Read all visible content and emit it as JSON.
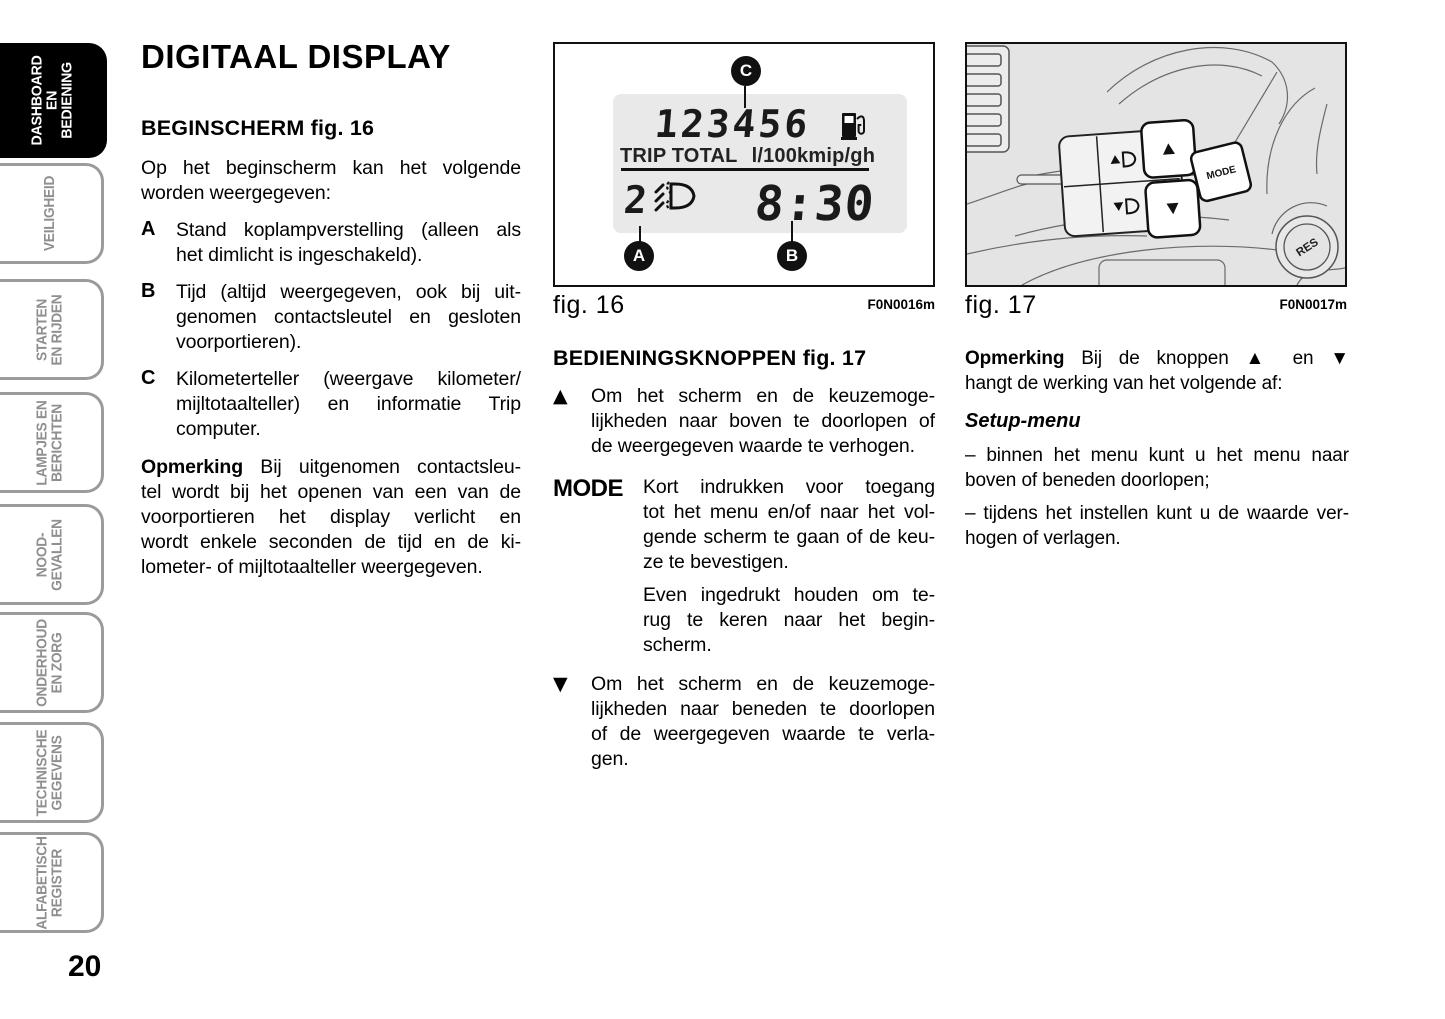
{
  "page": {
    "number": "20"
  },
  "sidebar": {
    "tabs": [
      {
        "id": "dashboard-en-bediening",
        "active": true,
        "lines": [
          "DASHBOARD",
          "EN BEDIENING"
        ]
      },
      {
        "id": "veiligheid",
        "active": false,
        "lines": [
          "VEILIGHEID"
        ]
      },
      {
        "id": "starten-en-rijden",
        "active": false,
        "lines": [
          "STARTEN",
          "EN RIJDEN"
        ]
      },
      {
        "id": "lampjes-en-berichten",
        "active": false,
        "lines": [
          "LAMPJES EN",
          "BERICHTEN"
        ]
      },
      {
        "id": "nood-gevallen",
        "active": false,
        "lines": [
          "NOOD-",
          "GEVALLEN"
        ]
      },
      {
        "id": "onderhoud-en-zorg",
        "active": false,
        "lines": [
          "ONDERHOUD",
          "EN ZORG"
        ]
      },
      {
        "id": "technische-gegevens",
        "active": false,
        "lines": [
          "TECHNISCHE",
          "GEGEVENS"
        ]
      },
      {
        "id": "alfabetisch-register",
        "active": false,
        "lines": [
          "ALFABETISCH",
          "REGISTER"
        ]
      }
    ]
  },
  "left_column": {
    "title": "DIGITAAL DISPLAY",
    "section_heading": "BEGINSCHERM fig. 16",
    "intro_lines": [
      "Op het beginscherm kan het volgende",
      "worden weergegeven:"
    ],
    "items": [
      {
        "key": "A",
        "lines": [
          "Stand koplampverstelling (alleen als",
          "het dimlicht is ingeschakeld)."
        ]
      },
      {
        "key": "B",
        "lines": [
          "Tijd (altijd weergegeven, ook bij uit-",
          "genomen contactsleutel en gesloten",
          "voorportieren)."
        ]
      },
      {
        "key": "C",
        "lines": [
          "Kilometerteller (weergave kilometer/",
          "mijltotaalteller) en informatie Trip",
          "computer."
        ]
      }
    ],
    "note_lines": [
      "**Opmerking** Bij uitgenomen contactsleu-",
      "tel wordt bij het openen van een van de",
      "voorportieren het display verlicht en",
      "wordt enkele seconden de tijd en de ki-",
      "lometer- of mijltotaalteller weergegeven."
    ]
  },
  "figure16": {
    "caption": "fig. 16",
    "code": "F0N0016m",
    "odometer": "123456",
    "trip_label": "TRIP TOTAL",
    "units_label": "l/100kmip/gh",
    "headlight_position": "2",
    "time": "8:30",
    "callouts": {
      "a": "A",
      "b": "B",
      "c": "C"
    }
  },
  "middle_column": {
    "section_heading": "BEDIENINGSKNOPPEN fig. 17",
    "up_marker": "▲",
    "up_lines": [
      "Om het scherm en de keuzemoge-",
      "lijkheden naar boven te doorlopen of",
      "de weergegeven waarde te verhogen."
    ],
    "mode_label": "MODE",
    "mode_lines_1": [
      "Kort indrukken voor toegang",
      "tot het menu en/of naar het vol-",
      "gende scherm te gaan of de keu-",
      "ze te bevestigen."
    ],
    "mode_lines_2": [
      "Even ingedrukt houden om te-",
      "rug te keren naar het begin-",
      "scherm."
    ],
    "down_marker": "▼",
    "down_lines": [
      "Om het scherm en de keuzemoge-",
      "lijkheden naar beneden te doorlopen",
      "of de weergegeven waarde te verla-",
      "gen."
    ]
  },
  "figure17": {
    "caption": "fig. 17",
    "code": "F0N0017m",
    "mode_button": "MODE",
    "res_button": "RES"
  },
  "right_column": {
    "note_lines": [
      "**Opmerking** Bij de knoppen ▲ en ▼",
      "hangt de werking van het volgende af:"
    ],
    "setup_heading": "Setup-menu",
    "bullet1_lines": [
      "– binnen het menu kunt u het menu naar",
      "boven of beneden doorlopen;"
    ],
    "bullet2_lines": [
      "– tijdens het instellen kunt u de waarde ver-",
      "hogen of verlagen."
    ]
  }
}
